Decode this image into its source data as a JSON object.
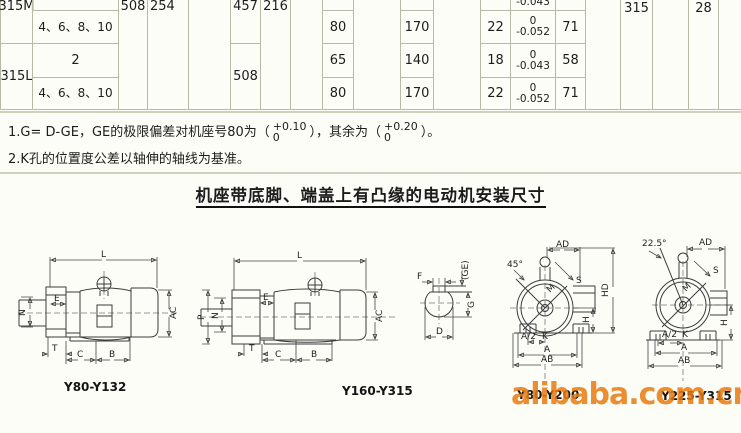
{
  "page": {
    "heading": "机座带底脚、端盖上有凸缘的电动机安装尺寸"
  },
  "table": {
    "frame_m": "315M",
    "frame_l": "315L",
    "poles_multi_1": "4、6、8、10",
    "poles_two": "2",
    "poles_multi_2": "4、6、8、10",
    "a": "508",
    "a_half": "254",
    "b_315m": "457",
    "b_315l": "508",
    "c": "216",
    "h": "315",
    "k": "28",
    "cut_tol": "-0.043",
    "row_b": {
      "d": "80",
      "e": "170",
      "f": "22",
      "tol_top": "0",
      "tol_bot": "-0.052",
      "g": "71"
    },
    "row_c": {
      "d": "65",
      "e": "140",
      "f": "18",
      "tol_top": "0",
      "tol_bot": "-0.043",
      "g": "58"
    },
    "row_d": {
      "d": "80",
      "e": "170",
      "f": "22",
      "tol_top": "0",
      "tol_bot": "-0.052",
      "g": "71"
    }
  },
  "notes": {
    "n1_pre": "1.G= D-GE，GE的极限偏差对机座号80为（",
    "n1_f1_top": "+0.10",
    "n1_f1_bot": "0",
    "n1_mid": "），其余为（",
    "n1_f2_top": "+0.20",
    "n1_f2_bot": "0",
    "n1_end": "）。",
    "n2": "2.K孔的位置度公差以轴伸的轴线为基准。"
  },
  "diagrams": {
    "d1": {
      "caption": "Y80-Y132",
      "labels": {
        "l": "L",
        "e": "E",
        "n": "N",
        "ac": "AC",
        "t": "T",
        "c": "C",
        "b": "B"
      }
    },
    "d2": {
      "caption": "Y160-Y315",
      "labels": {
        "l": "L",
        "e": "E",
        "p": "P",
        "n": "N",
        "ac": "AC",
        "t": "T",
        "c": "C",
        "b": "B"
      }
    },
    "shaft": {
      "labels": {
        "f": "F",
        "ge": "(GE)",
        "g": "G",
        "d": "D"
      }
    },
    "d3": {
      "caption": "Y80-Y200",
      "labels": {
        "angle": "45°",
        "ad": "AD",
        "s": "S",
        "m": "M",
        "hd": "HD",
        "h": "H",
        "a2": "A/2",
        "k": "K",
        "a": "A",
        "ab": "AB"
      }
    },
    "d4": {
      "caption": "Y225-Y315",
      "labels": {
        "angle": "22.5°",
        "ad": "AD",
        "s": "S",
        "m": "M",
        "h": "H",
        "a2": "A/2",
        "k": "K",
        "a": "A",
        "ab": "AB"
      }
    }
  },
  "watermark": "alibaba.com.cn"
}
